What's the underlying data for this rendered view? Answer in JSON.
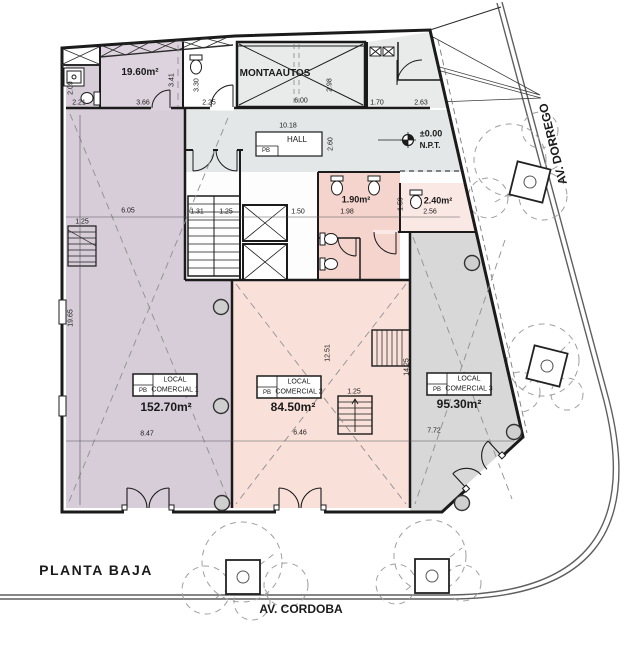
{
  "plan": {
    "floor_label": "PLANTA BAJA",
    "street_bottom": "AV. CORDOBA",
    "street_right": "AV. DORREGO",
    "level_marker": {
      "value": "±0.00",
      "datum": "N.P.T."
    },
    "rooms": {
      "montaautos": "MONTAAUTOS",
      "hall": "HALL",
      "hall_level": "PB",
      "top_left_area": "19.60m²",
      "bath1_area": "1.90m²",
      "bath2_area": "2.40m²"
    },
    "locals": [
      {
        "line1": "LOCAL",
        "line2": "COMERCIAL 1",
        "level": "PB",
        "area": "152.70m²"
      },
      {
        "line1": "LOCAL",
        "line2": "COMERCIAL 2",
        "level": "PB",
        "area": "84.50m²"
      },
      {
        "line1": "LOCAL",
        "line2": "COMERCIAL 3",
        "level": "PB",
        "area": "95.30m²"
      }
    ],
    "dimensions": {
      "d221": "2.21",
      "d209": "2.09",
      "d366": "3.66",
      "d341": "3.41",
      "d330": "3.30",
      "d225": "2.25",
      "d600": "6.00",
      "d298": "2.98",
      "d170": "1.70",
      "d263": "2.63",
      "d1018": "10.18",
      "d260": "2.60",
      "d131": "1.31",
      "d125a": "1.25",
      "d150": "1.50",
      "d198": "1.98",
      "d159": "1.59",
      "d256": "2.56",
      "d605": "6.05",
      "d125b": "1.25",
      "d1965": "19.65",
      "d847": "8.47",
      "d1251": "12.51",
      "d646": "6.46",
      "d125c": "1.25",
      "d1425": "14.25",
      "d772": "7.72"
    },
    "colors": {
      "local1_fill": "#d6cdd9",
      "local2_fill": "#f9e1da",
      "local3_fill": "#d8d8d8",
      "bath_fill": "#f5d4cd",
      "hall_fill": "#e3e7e8",
      "service_fill": "#e9ebeb",
      "wall": "#1b1b1b"
    }
  }
}
